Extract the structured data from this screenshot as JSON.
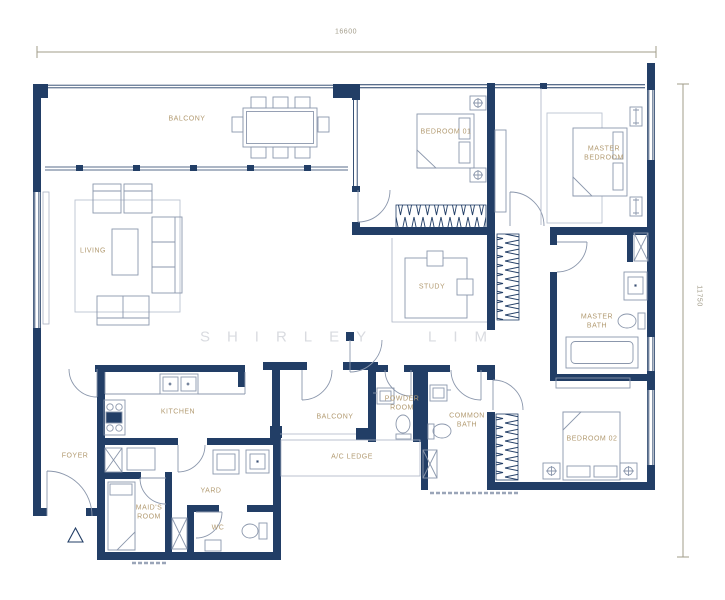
{
  "watermark": "SHIRLEY LIM",
  "dimensions": {
    "width_label": "16600",
    "height_label": "11750"
  },
  "rooms": {
    "balcony_top": "BALCONY",
    "bedroom_01": "BEDROOM 01",
    "master_bedroom": "MASTER BEDROOM",
    "living": "LIVING",
    "study": "STUDY",
    "master_bath": "MASTER BATH",
    "kitchen": "KITCHEN",
    "balcony_lower": "BALCONY",
    "powder_room": "POWDER ROOM",
    "ac_ledge": "A/C LEDGE",
    "common_bath": "COMMON BATH",
    "bedroom_02": "BEDROOM 02",
    "foyer": "FOYER",
    "maids_room": "MAID'S ROOM",
    "yard": "YARD",
    "wc": "WC"
  },
  "colors": {
    "wall": "#223e66",
    "furniture_line": "#8b97ac",
    "label": "#b29a70",
    "dimension": "#a29c8a",
    "watermark": "#d9dbe0"
  }
}
